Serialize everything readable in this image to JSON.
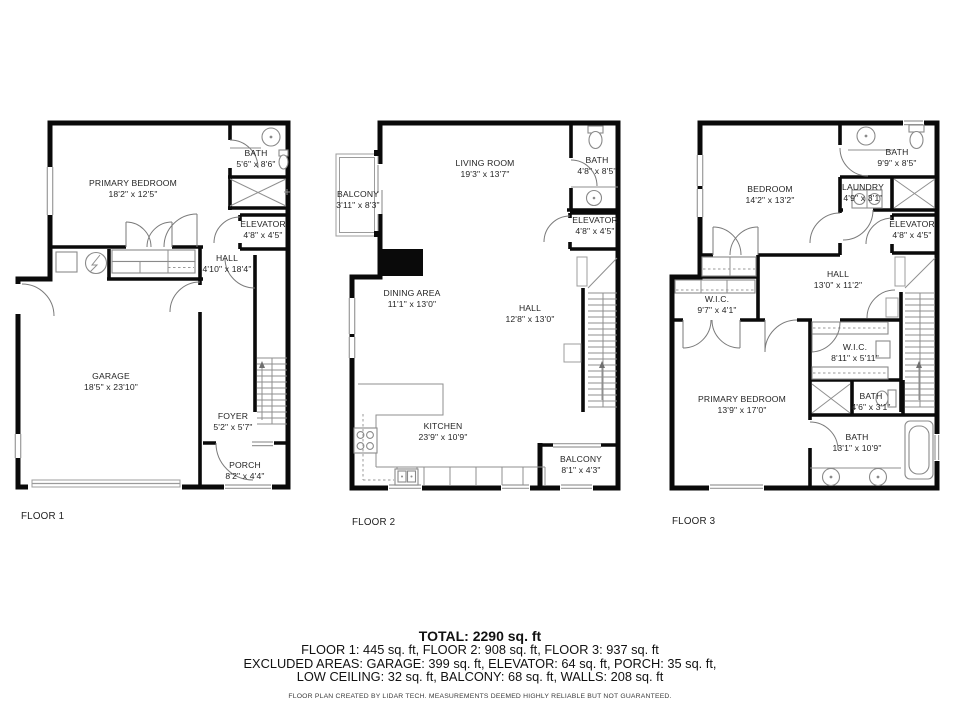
{
  "floors": [
    {
      "label": "FLOOR 1",
      "rooms": [
        {
          "name": "PRIMARY BEDROOM",
          "dims": "18'2\" x 12'5\""
        },
        {
          "name": "BATH",
          "dims": "5'6\" x 8'6\""
        },
        {
          "name": "ELEVATOR",
          "dims": "4'8\" x 4'5\""
        },
        {
          "name": "HALL",
          "dims": "4'10\" x 18'4\""
        },
        {
          "name": "GARAGE",
          "dims": "18'5\" x 23'10\""
        },
        {
          "name": "FOYER",
          "dims": "5'2\" x 5'7\""
        },
        {
          "name": "PORCH",
          "dims": "8'2\" x 4'4\""
        }
      ]
    },
    {
      "label": "FLOOR 2",
      "rooms": [
        {
          "name": "LIVING ROOM",
          "dims": "19'3\" x 13'7\""
        },
        {
          "name": "BALCONY",
          "dims": "3'11\" x 8'3\""
        },
        {
          "name": "BATH",
          "dims": "4'8\" x 8'5\""
        },
        {
          "name": "ELEVATOR",
          "dims": "4'8\" x 4'5\""
        },
        {
          "name": "DINING AREA",
          "dims": "11'1\" x 13'0\""
        },
        {
          "name": "HALL",
          "dims": "12'8\" x 13'0\""
        },
        {
          "name": "KITCHEN",
          "dims": "23'9\" x 10'9\""
        },
        {
          "name": "BALCONY",
          "dims": "8'1\" x 4'3\""
        }
      ]
    },
    {
      "label": "FLOOR 3",
      "rooms": [
        {
          "name": "BEDROOM",
          "dims": "14'2\" x 13'2\""
        },
        {
          "name": "BATH",
          "dims": "9'9\" x 8'5\""
        },
        {
          "name": "LAUNDRY",
          "dims": "4'9\" x 3'1\""
        },
        {
          "name": "ELEVATOR",
          "dims": "4'8\" x 4'5\""
        },
        {
          "name": "HALL",
          "dims": "13'0\" x 11'2\""
        },
        {
          "name": "W.I.C.",
          "dims": "9'7\" x 4'1\""
        },
        {
          "name": "W.I.C.",
          "dims": "8'11\" x 5'11\""
        },
        {
          "name": "PRIMARY BEDROOM",
          "dims": "13'9\" x 17'0\""
        },
        {
          "name": "BATH",
          "dims": "4'6\" x 3'1\""
        },
        {
          "name": "BATH",
          "dims": "13'1\" x 10'9\""
        }
      ]
    }
  ],
  "summary": {
    "total": "TOTAL: 2290 sq. ft",
    "floors_line": "FLOOR 1: 445 sq. ft, FLOOR 2: 908 sq. ft, FLOOR 3: 937 sq. ft",
    "excluded_line1": "EXCLUDED AREAS: GARAGE: 399 sq. ft, ELEVATOR: 64 sq. ft, PORCH: 35 sq. ft,",
    "excluded_line2": "LOW CEILING: 32 sq. ft, BALCONY: 68 sq. ft, WALLS: 208 sq. ft",
    "disclaimer": "FLOOR PLAN CREATED BY LIDAR TECH. MEASUREMENTS DEEMED HIGHLY RELIABLE BUT NOT GUARANTEED."
  },
  "colors": {
    "wall": "#0a0a0a",
    "thin_line": "#8f8f8f",
    "text": "#242424"
  }
}
